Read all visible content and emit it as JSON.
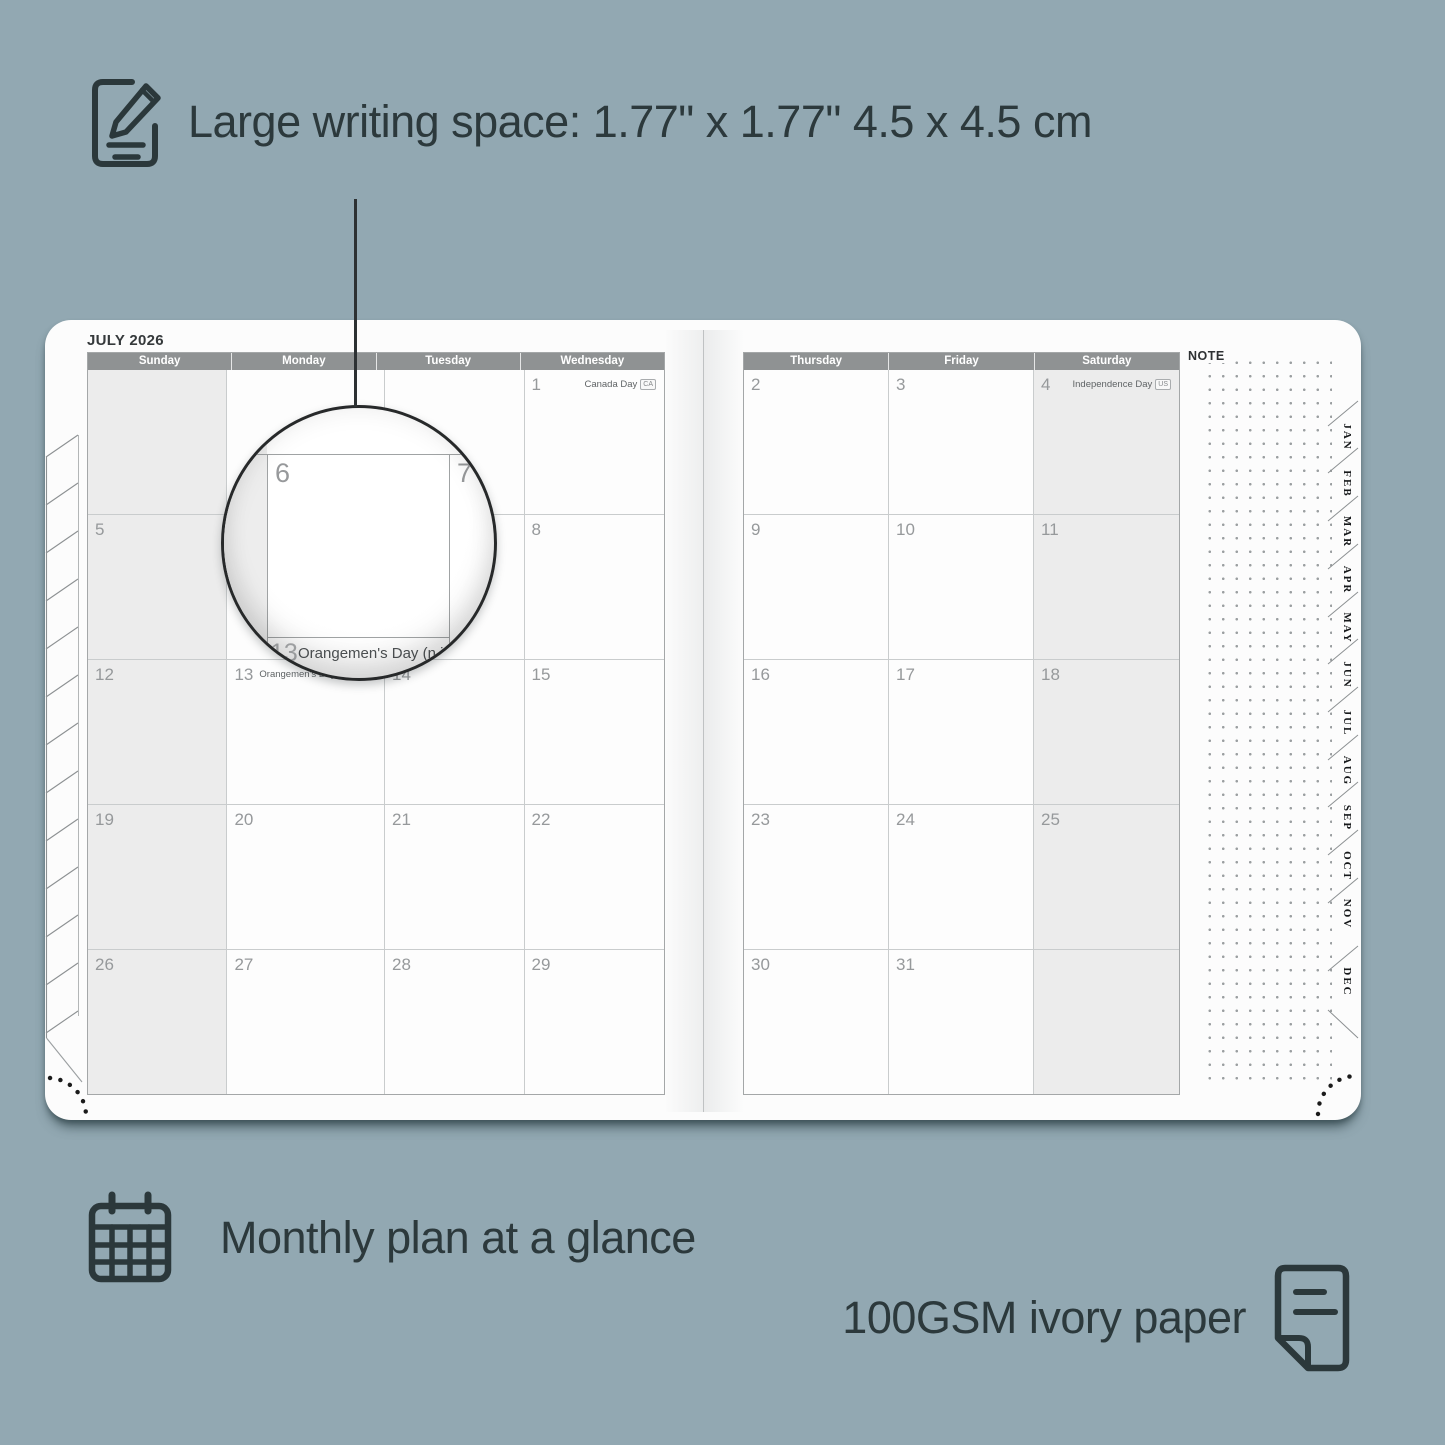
{
  "colors": {
    "background": "#92a8b2",
    "ink": "#2c393c",
    "page": "#fcfcfc",
    "header_bar": "#8f9293",
    "cell_shade": "#ececec",
    "grid_line": "#c9cccd",
    "date_number": "#96999b"
  },
  "annotations": {
    "writing_space": "Large writing space: 1.77\" x 1.77\" 4.5 x 4.5 cm",
    "monthly_plan": "Monthly plan at a glance",
    "paper": "100GSM ivory paper"
  },
  "planner": {
    "title": "JULY 2026",
    "note_label": "NOTE",
    "left_day_headers": [
      "Sunday",
      "Monday",
      "Tuesday",
      "Wednesday"
    ],
    "right_day_headers": [
      "Thursday",
      "Friday",
      "Saturday"
    ],
    "left_weeks": [
      [
        {
          "d": ""
        },
        {
          "d": ""
        },
        {
          "d": ""
        },
        {
          "d": "1",
          "h": "Canada Day",
          "b": "CA"
        }
      ],
      [
        {
          "d": "5"
        },
        {
          "d": "6"
        },
        {
          "d": "7"
        },
        {
          "d": "8"
        }
      ],
      [
        {
          "d": "12"
        },
        {
          "d": "13",
          "h": "Orangemen's Day (n.i.)",
          "b": "UK",
          "align": "left"
        },
        {
          "d": "14"
        },
        {
          "d": "15"
        }
      ],
      [
        {
          "d": "19"
        },
        {
          "d": "20"
        },
        {
          "d": "21"
        },
        {
          "d": "22"
        }
      ],
      [
        {
          "d": "26"
        },
        {
          "d": "27"
        },
        {
          "d": "28"
        },
        {
          "d": "29"
        }
      ]
    ],
    "right_weeks": [
      [
        {
          "d": "2"
        },
        {
          "d": "3"
        },
        {
          "d": "4",
          "h": "Independence Day",
          "b": "US"
        }
      ],
      [
        {
          "d": "9"
        },
        {
          "d": "10"
        },
        {
          "d": "11"
        }
      ],
      [
        {
          "d": "16"
        },
        {
          "d": "17"
        },
        {
          "d": "18"
        }
      ],
      [
        {
          "d": "23"
        },
        {
          "d": "24"
        },
        {
          "d": "25"
        }
      ],
      [
        {
          "d": "30"
        },
        {
          "d": "31"
        },
        {
          "d": ""
        }
      ]
    ],
    "month_tabs": [
      "JAN",
      "FEB",
      "MAR",
      "APR",
      "MAY",
      "JUN",
      "JUL",
      "AUG",
      "SEP",
      "OCT",
      "NOV",
      "DEC"
    ]
  },
  "magnifier": {
    "day_left": "6",
    "day_right": "7",
    "day_below": "13",
    "holiday": "Orangemen's Day (n.i.)",
    "badge": "UK"
  }
}
